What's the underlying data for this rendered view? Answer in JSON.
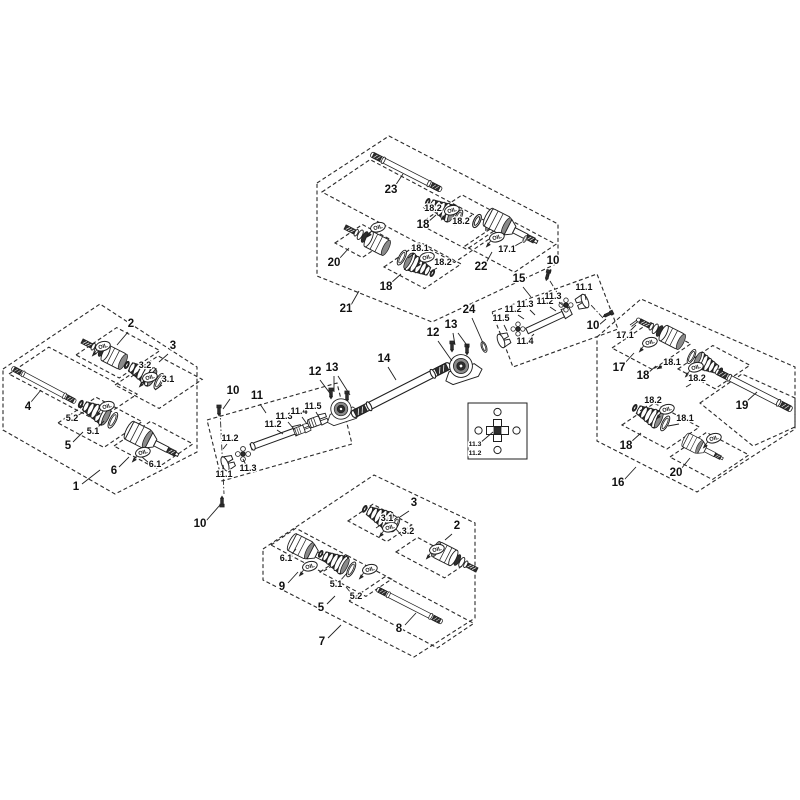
{
  "figure": {
    "background": "#ffffff",
    "ink": "#1f1f1f",
    "dark_fill": "#2e2e2e",
    "gray_fill": "#8a8a8a"
  },
  "oil": {
    "label": "OIL",
    "points": [
      [
        100,
        347
      ],
      [
        147,
        378
      ],
      [
        104,
        407
      ],
      [
        140,
        453
      ],
      [
        375,
        228
      ],
      [
        449,
        211
      ],
      [
        494,
        238
      ],
      [
        424,
        258
      ],
      [
        647,
        343
      ],
      [
        693,
        368
      ],
      [
        664,
        410
      ],
      [
        711,
        439
      ],
      [
        387,
        528
      ],
      [
        434,
        550
      ],
      [
        307,
        567
      ],
      [
        367,
        570
      ]
    ]
  },
  "labels": [
    {
      "t": "1",
      "x": 76,
      "y": 490,
      "s": "lg",
      "ld": [
        [
          82,
          484,
          100,
          470
        ]
      ]
    },
    {
      "t": "2",
      "x": 131,
      "y": 327,
      "s": "lg",
      "ld": [
        [
          128,
          332,
          117,
          345
        ]
      ]
    },
    {
      "t": "3",
      "x": 173,
      "y": 349,
      "s": "lg",
      "ld": [
        [
          168,
          354,
          159,
          362
        ]
      ]
    },
    {
      "t": "4",
      "x": 28,
      "y": 410,
      "s": "lg",
      "ld": [
        [
          31,
          402,
          41,
          390
        ]
      ]
    },
    {
      "t": "5",
      "x": 68,
      "y": 449,
      "s": "lg",
      "ld": [
        [
          73,
          442,
          83,
          432
        ]
      ]
    },
    {
      "t": "6",
      "x": 114,
      "y": 474,
      "s": "lg",
      "ld": [
        [
          119,
          467,
          129,
          457
        ]
      ]
    },
    {
      "t": "3.2",
      "x": 145,
      "y": 368,
      "s": "sm",
      "ld": [
        [
          139,
          371,
          131,
          377
        ]
      ]
    },
    {
      "t": "3.1",
      "x": 168,
      "y": 382,
      "s": "sm",
      "ld": [
        [
          162,
          385,
          155,
          390
        ]
      ]
    },
    {
      "t": "5.2",
      "x": 72,
      "y": 421,
      "s": "sm",
      "ld": [
        [
          77,
          416,
          85,
          411
        ]
      ]
    },
    {
      "t": "5.1",
      "x": 93,
      "y": 434,
      "s": "sm",
      "ld": [
        [
          97,
          428,
          104,
          421
        ]
      ]
    },
    {
      "t": "6.1",
      "x": 155,
      "y": 467,
      "s": "sm",
      "ld": [
        [
          149,
          463,
          142,
          457
        ]
      ]
    },
    {
      "t": "23",
      "x": 391,
      "y": 193,
      "s": "lg",
      "ld": [
        [
          395,
          186,
          403,
          174
        ]
      ]
    },
    {
      "t": "18.2",
      "x": 433,
      "y": 211,
      "s": "sm",
      "ar": true,
      "ld": [
        [
          424,
          209,
          428,
          206
        ]
      ]
    },
    {
      "t": "18.2",
      "x": 461,
      "y": 224,
      "s": "sm",
      "ld": [
        [
          466,
          220,
          472,
          215
        ]
      ]
    },
    {
      "t": "18",
      "x": 423,
      "y": 228,
      "s": "lg",
      "ld": [
        [
          428,
          222,
          436,
          215
        ]
      ]
    },
    {
      "t": "20",
      "x": 334,
      "y": 266,
      "s": "lg",
      "ld": [
        [
          339,
          259,
          349,
          248
        ]
      ]
    },
    {
      "t": "18.1",
      "x": 420,
      "y": 251,
      "s": "sm",
      "ld": [
        [
          414,
          254,
          408,
          258
        ]
      ]
    },
    {
      "t": "18.2",
      "x": 443,
      "y": 265,
      "s": "sm",
      "ld": [
        [
          437,
          268,
          430,
          272
        ]
      ]
    },
    {
      "t": "18",
      "x": 386,
      "y": 290,
      "s": "lg",
      "ld": [
        [
          391,
          283,
          401,
          274
        ]
      ]
    },
    {
      "t": "21",
      "x": 346,
      "y": 312,
      "s": "lg",
      "ld": [
        [
          351,
          305,
          359,
          291
        ]
      ]
    },
    {
      "t": "22",
      "x": 481,
      "y": 270,
      "s": "lg",
      "ld": [
        [
          486,
          263,
          492,
          252
        ]
      ]
    },
    {
      "t": "17.1",
      "x": 507,
      "y": 252,
      "s": "sm",
      "ld": [
        [
          513,
          247,
          522,
          242
        ]
      ]
    },
    {
      "t": "17.1",
      "x": 625,
      "y": 338,
      "s": "sm",
      "ld": [
        [
          629,
          332,
          636,
          325
        ]
      ]
    },
    {
      "t": "17",
      "x": 619,
      "y": 371,
      "s": "lg",
      "ld": [
        [
          624,
          364,
          634,
          353
        ]
      ]
    },
    {
      "t": "18.1",
      "x": 672,
      "y": 365,
      "s": "sm",
      "ar": true,
      "ld": [
        [
          662,
          366,
          657,
          369
        ]
      ]
    },
    {
      "t": "18",
      "x": 643,
      "y": 379,
      "s": "lg",
      "ld": [
        [
          648,
          373,
          656,
          366
        ]
      ]
    },
    {
      "t": "18.2",
      "x": 697,
      "y": 381,
      "s": "sm",
      "ld": [
        [
          691,
          384,
          686,
          387
        ]
      ]
    },
    {
      "t": "19",
      "x": 742,
      "y": 409,
      "s": "lg",
      "ld": [
        [
          746,
          402,
          757,
          392
        ]
      ]
    },
    {
      "t": "18.2",
      "x": 653,
      "y": 403,
      "s": "sm",
      "ld": [
        [
          647,
          406,
          640,
          411
        ]
      ]
    },
    {
      "t": "18.1",
      "x": 685,
      "y": 421,
      "s": "sm",
      "ld": [
        [
          679,
          424,
          668,
          426
        ]
      ]
    },
    {
      "t": "18",
      "x": 626,
      "y": 449,
      "s": "lg",
      "ld": [
        [
          631,
          442,
          641,
          433
        ]
      ]
    },
    {
      "t": "20",
      "x": 676,
      "y": 476,
      "s": "lg",
      "ld": [
        [
          681,
          469,
          690,
          458
        ]
      ]
    },
    {
      "t": "16",
      "x": 618,
      "y": 486,
      "s": "lg",
      "ld": [
        [
          624,
          480,
          636,
          467
        ]
      ]
    },
    {
      "t": "3",
      "x": 414,
      "y": 506,
      "s": "lg",
      "ld": [
        [
          409,
          511,
          400,
          517
        ]
      ]
    },
    {
      "t": "3.1",
      "x": 387,
      "y": 521,
      "s": "sm",
      "ld": [
        [
          382,
          524,
          376,
          528
        ]
      ]
    },
    {
      "t": "3.2",
      "x": 408,
      "y": 534,
      "s": "sm",
      "ld": [
        [
          402,
          536,
          396,
          529
        ]
      ]
    },
    {
      "t": "2",
      "x": 457,
      "y": 529,
      "s": "lg",
      "ld": [
        [
          452,
          534,
          445,
          540
        ]
      ]
    },
    {
      "t": "6.1",
      "x": 286,
      "y": 561,
      "s": "sm",
      "ld": [
        [
          291,
          555,
          296,
          549
        ]
      ]
    },
    {
      "t": "9",
      "x": 282,
      "y": 590,
      "s": "lg",
      "ld": [
        [
          288,
          583,
          298,
          572
        ]
      ]
    },
    {
      "t": "5.1",
      "x": 336,
      "y": 587,
      "s": "sm",
      "ld": [
        [
          340,
          581,
          347,
          573
        ]
      ]
    },
    {
      "t": "5.2",
      "x": 356,
      "y": 599,
      "s": "sm",
      "ld": [
        [
          351,
          593,
          346,
          587
        ]
      ]
    },
    {
      "t": "5",
      "x": 321,
      "y": 611,
      "s": "lg",
      "ld": [
        [
          327,
          604,
          335,
          596
        ]
      ]
    },
    {
      "t": "8",
      "x": 399,
      "y": 632,
      "s": "lg",
      "ld": [
        [
          405,
          625,
          416,
          613
        ]
      ]
    },
    {
      "t": "7",
      "x": 322,
      "y": 645,
      "s": "lg",
      "ld": [
        [
          328,
          638,
          341,
          625
        ]
      ]
    },
    {
      "t": "10",
      "x": 233,
      "y": 394,
      "s": "lg",
      "ld": [
        [
          230,
          399,
          223,
          409
        ]
      ]
    },
    {
      "t": "10",
      "x": 200,
      "y": 527,
      "s": "lg",
      "ld": [
        [
          206,
          521,
          220,
          505
        ]
      ]
    },
    {
      "t": "11",
      "x": 257,
      "y": 399,
      "s": "lg",
      "ld": [
        [
          260,
          404,
          266,
          413
        ]
      ]
    },
    {
      "t": "11.2",
      "x": 273,
      "y": 427,
      "s": "sm",
      "ld": [
        [
          277,
          430,
          283,
          434
        ]
      ]
    },
    {
      "t": "11.3",
      "x": 284,
      "y": 419,
      "s": "sm",
      "ld": [
        [
          288,
          422,
          293,
          428
        ]
      ]
    },
    {
      "t": "11.4",
      "x": 299,
      "y": 414,
      "s": "sm",
      "ld": [
        [
          302,
          417,
          307,
          424
        ]
      ]
    },
    {
      "t": "11.5",
      "x": 313,
      "y": 409,
      "s": "sm",
      "ld": [
        [
          316,
          412,
          320,
          419
        ]
      ]
    },
    {
      "t": "11.2",
      "x": 230,
      "y": 441,
      "s": "sm",
      "ld": [
        [
          227,
          444,
          223,
          449
        ]
      ]
    },
    {
      "t": "11.1",
      "x": 224,
      "y": 477,
      "s": "sm",
      "ld": [
        [
          224,
          471,
          223,
          465
        ]
      ]
    },
    {
      "t": "11.3",
      "x": 248,
      "y": 471,
      "s": "sm",
      "ld": [
        [
          246,
          465,
          243,
          459
        ]
      ]
    },
    {
      "t": "12",
      "x": 315,
      "y": 375,
      "s": "lg",
      "ld": [
        [
          320,
          380,
          332,
          396
        ]
      ]
    },
    {
      "t": "13",
      "x": 332,
      "y": 371,
      "s": "lg",
      "ld": [
        [
          334,
          376,
          334,
          392
        ],
        [
          338,
          376,
          350,
          395
        ]
      ]
    },
    {
      "t": "14",
      "x": 384,
      "y": 362,
      "s": "lg",
      "ld": [
        [
          388,
          367,
          396,
          380
        ]
      ]
    },
    {
      "t": "12",
      "x": 433,
      "y": 336,
      "s": "lg",
      "ld": [
        [
          438,
          341,
          452,
          361
        ]
      ]
    },
    {
      "t": "13",
      "x": 451,
      "y": 328,
      "s": "lg",
      "ld": [
        [
          453,
          333,
          455,
          345
        ],
        [
          458,
          333,
          469,
          348
        ]
      ]
    },
    {
      "t": "24",
      "x": 469,
      "y": 313,
      "s": "lg",
      "ld": [
        [
          472,
          318,
          483,
          343
        ]
      ]
    },
    {
      "t": "15",
      "x": 519,
      "y": 282,
      "s": "lg",
      "ld": [
        [
          523,
          287,
          531,
          297
        ]
      ]
    },
    {
      "t": "10",
      "x": 553,
      "y": 264,
      "s": "lg",
      "ld": [
        [
          551,
          269,
          548,
          276
        ]
      ]
    },
    {
      "t": "10",
      "x": 593,
      "y": 329,
      "s": "lg",
      "ld": [
        [
          599,
          325,
          606,
          319
        ]
      ]
    },
    {
      "t": "11.5",
      "x": 501,
      "y": 321,
      "s": "sm",
      "ld": [
        [
          504,
          325,
          507,
          331
        ]
      ]
    },
    {
      "t": "11.4",
      "x": 525,
      "y": 344,
      "s": "sm",
      "ld": [
        [
          529,
          339,
          534,
          334
        ]
      ]
    },
    {
      "t": "11.2",
      "x": 513,
      "y": 312,
      "s": "sm",
      "ld": [
        [
          518,
          315,
          524,
          319
        ]
      ]
    },
    {
      "t": "11.3",
      "x": 525,
      "y": 307,
      "s": "sm",
      "ld": [
        [
          530,
          310,
          535,
          315
        ]
      ]
    },
    {
      "t": "11.2",
      "x": 545,
      "y": 304,
      "s": "sm",
      "ld": [
        [
          550,
          307,
          556,
          311
        ]
      ]
    },
    {
      "t": "11.3",
      "x": 553,
      "y": 299,
      "s": "sm",
      "ld": [
        [
          559,
          302,
          565,
          307
        ]
      ]
    },
    {
      "t": "11.1",
      "x": 584,
      "y": 290,
      "s": "sm",
      "ld": [
        [
          585,
          294,
          586,
          300
        ]
      ]
    },
    {
      "t": "11.3",
      "x": 475,
      "y": 446,
      "s": "xs",
      "ld": [
        [
          480,
          443,
          493,
          432
        ]
      ]
    },
    {
      "t": "11.2",
      "x": 475,
      "y": 455,
      "s": "xs"
    }
  ]
}
